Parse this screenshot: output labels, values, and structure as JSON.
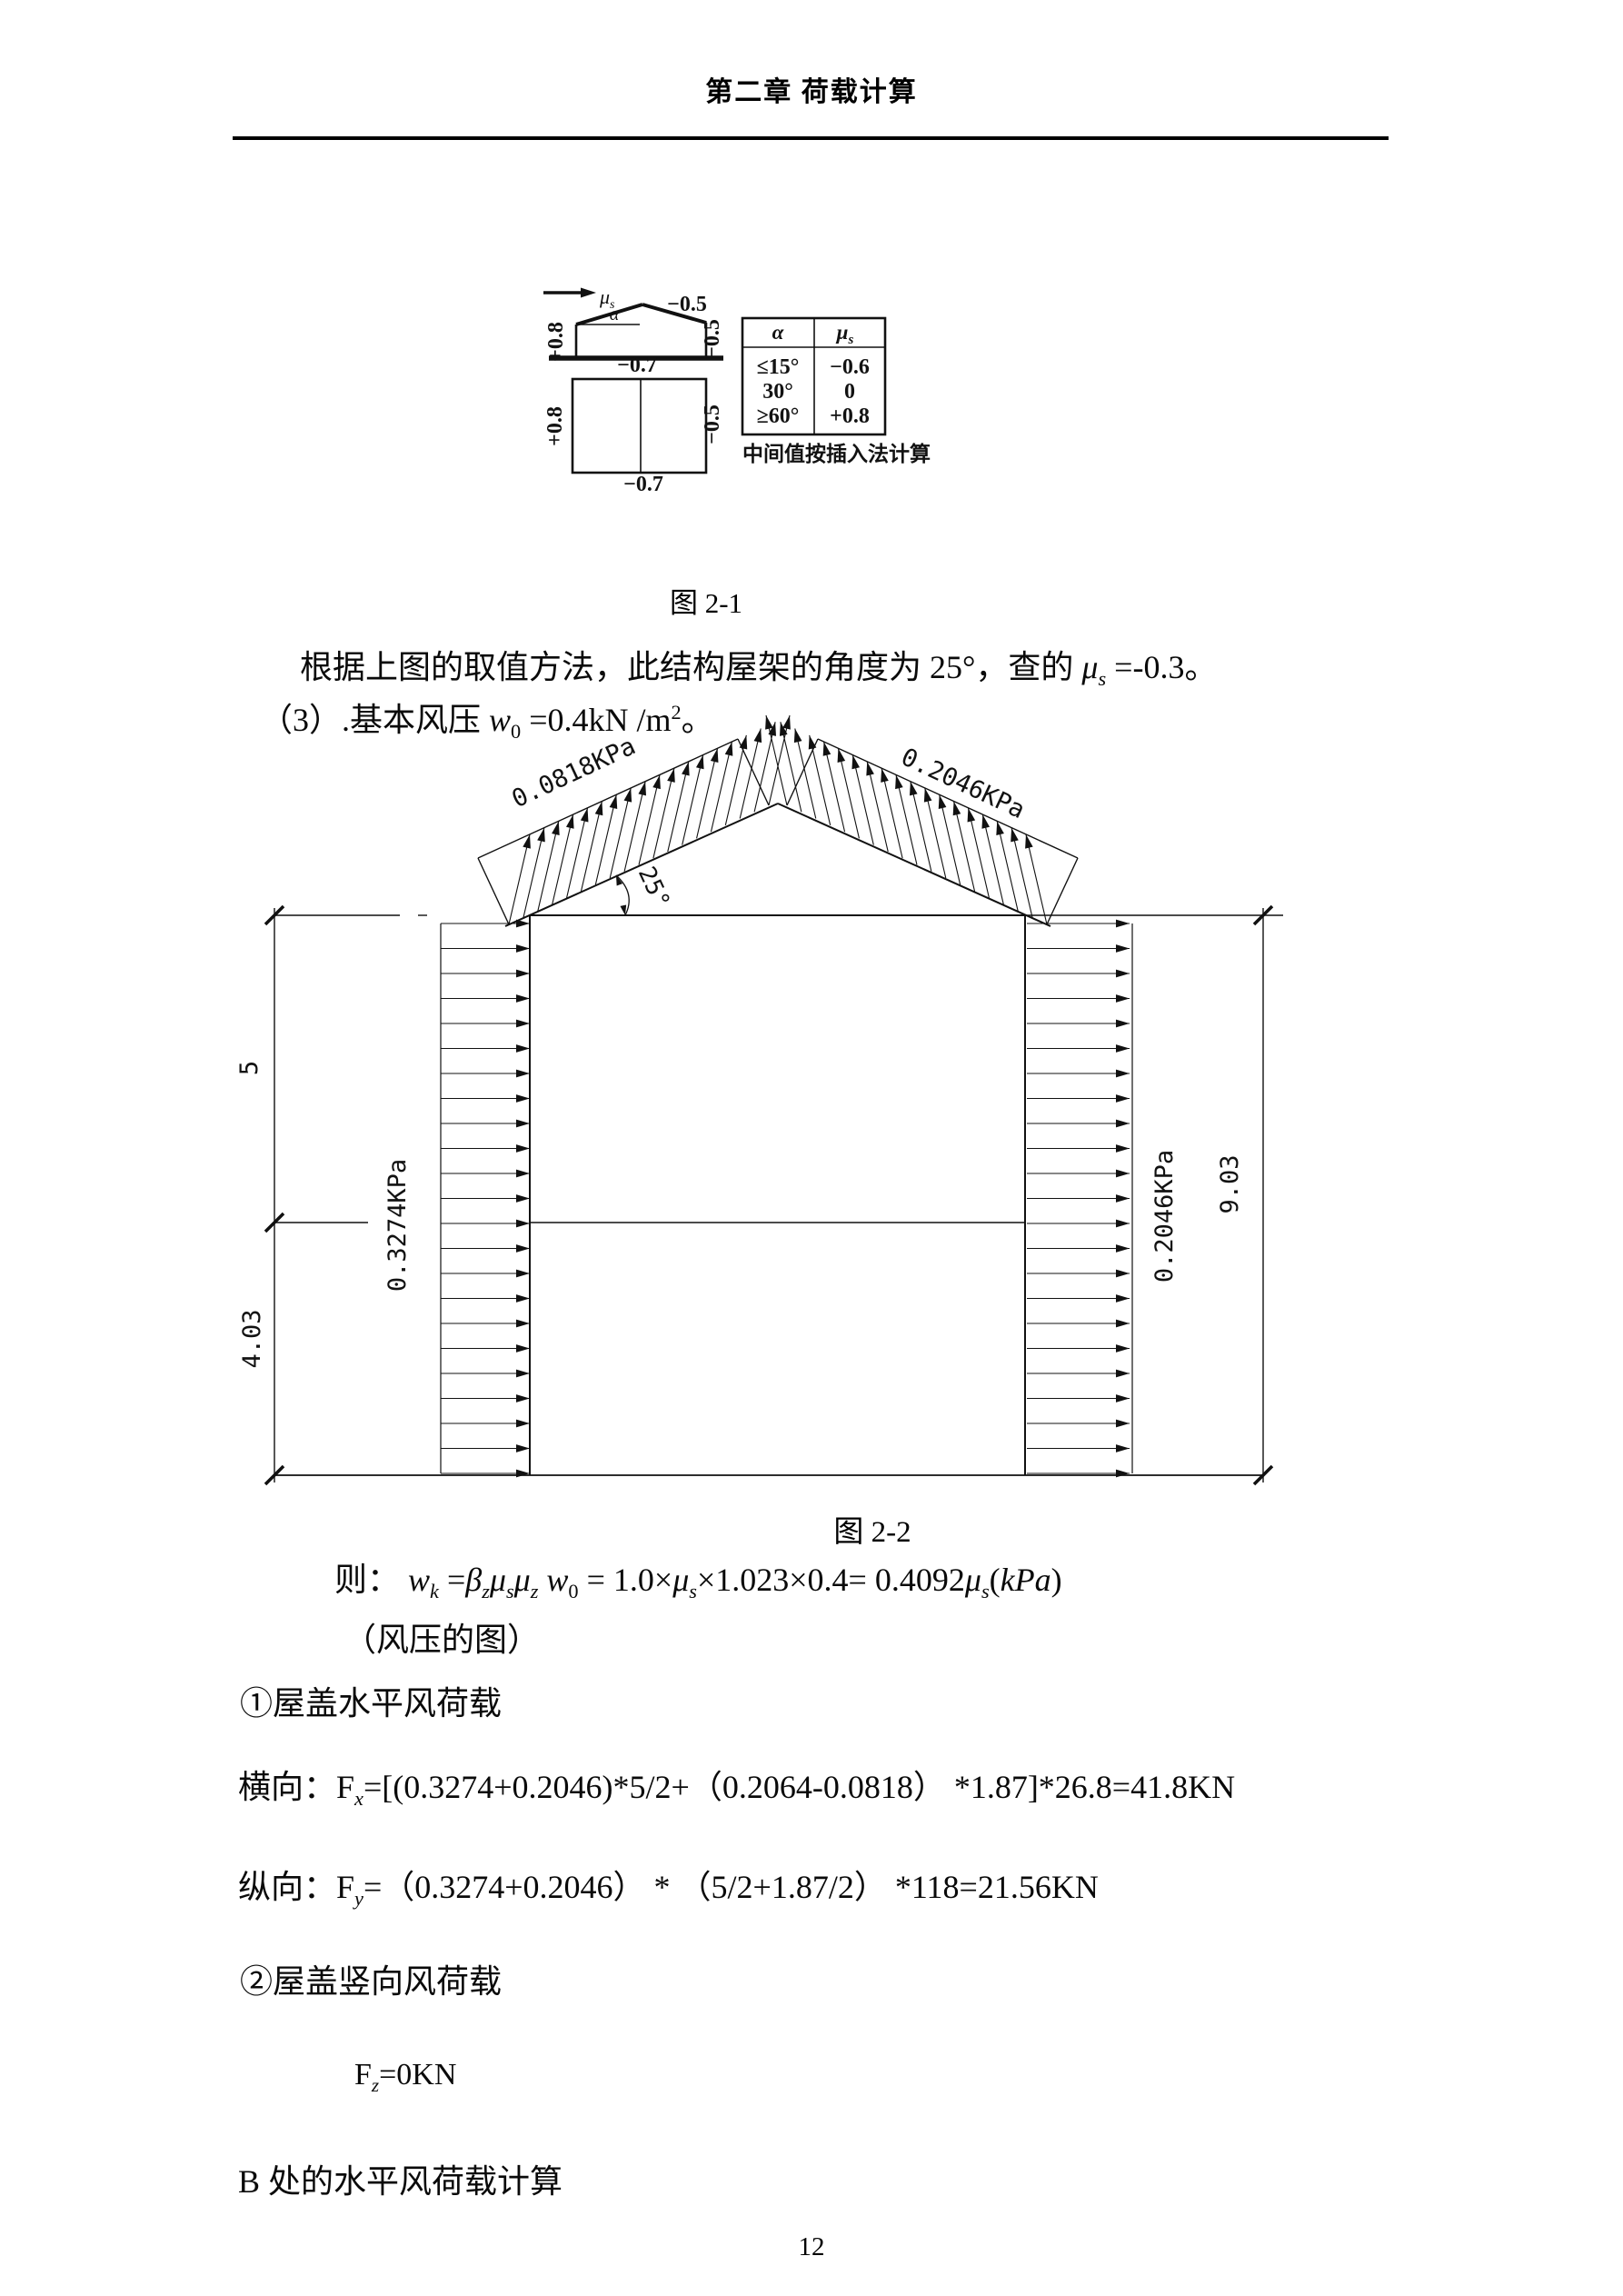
{
  "page": {
    "header_title": "第二章  荷载计算",
    "page_number": "12"
  },
  "figure1": {
    "caption": "图  2-1",
    "labels": {
      "mu": "μ",
      "mu_sub": "s",
      "alpha": "α",
      "roof_right": "−0.5",
      "wall_left": "+0.8",
      "wall_right": "−0.5",
      "plan_top": "−0.7",
      "plan_bottom": "−0.7",
      "plan_left": "+0.8",
      "plan_right": "−0.5"
    },
    "table": {
      "header_alpha": "α",
      "header_mu": "μ",
      "header_mu_sub": "s",
      "rows": [
        [
          "≤15°",
          "−0.6"
        ],
        [
          "30°",
          "0"
        ],
        [
          "≥60°",
          "+0.8"
        ]
      ]
    },
    "note": "中间值按插入法计算"
  },
  "figure2": {
    "caption": "图 2-2",
    "roof_left_pressure": "0.0818KPa",
    "roof_right_pressure": "0.2046KPa",
    "roof_angle": "25°",
    "left_wall_pressure": "0.3274KPa",
    "right_wall_pressure": "0.2046KPa",
    "dim_upper": "5",
    "dim_lower": "4.03",
    "dim_total": "9.03"
  },
  "text": {
    "p_mu": [
      {
        "t": "根据上图的取值方法，此结构屋架的角度为 25°，查的 "
      },
      {
        "t": "μ",
        "s": "it"
      },
      {
        "t": "s",
        "s": "subit"
      },
      {
        "t": " =-0.3。"
      }
    ],
    "p_w0": [
      {
        "t": "（3）.基本风压  "
      },
      {
        "t": "w",
        "s": "it"
      },
      {
        "t": "0",
        "s": "sub"
      },
      {
        "t": " =0.4kN /m"
      },
      {
        "t": "2",
        "s": "sup"
      },
      {
        "t": "。"
      }
    ],
    "f_wk": [
      {
        "t": "则：  "
      },
      {
        "t": "w",
        "s": "it"
      },
      {
        "t": "k",
        "s": "subit"
      },
      {
        "t": " ="
      },
      {
        "t": "β",
        "s": "it"
      },
      {
        "t": "z",
        "s": "subit"
      },
      {
        "t": "μ",
        "s": "it"
      },
      {
        "t": "s",
        "s": "subit"
      },
      {
        "t": "μ",
        "s": "it"
      },
      {
        "t": "z",
        "s": "subit"
      },
      {
        "t": " "
      },
      {
        "t": "w",
        "s": "it"
      },
      {
        "t": "0",
        "s": "sub"
      },
      {
        "t": " = 1.0×"
      },
      {
        "t": "μ",
        "s": "it"
      },
      {
        "t": "s",
        "s": "subit"
      },
      {
        "t": "×1.023×0.4= 0.4092"
      },
      {
        "t": "μ",
        "s": "it"
      },
      {
        "t": "s",
        "s": "subit"
      },
      {
        "t": "("
      },
      {
        "t": "kPa",
        "s": "it"
      },
      {
        "t": ")"
      }
    ],
    "p_fengya": "（风压的图）",
    "item1": "①屋盖水平风荷载",
    "f_fx": [
      {
        "t": "横向："
      },
      {
        "t": "F"
      },
      {
        "t": "x",
        "s": "subit"
      },
      {
        "t": "=[(0.3274+0.2046)*5/2+（0.2064-0.0818） *1.87]*26.8=41.8KN"
      }
    ],
    "f_fy": [
      {
        "t": "纵向："
      },
      {
        "t": "F"
      },
      {
        "t": "y",
        "s": "subit"
      },
      {
        "t": "=（0.3274+0.2046） * （5/2+1.87/2） *118=21.56KN"
      }
    ],
    "item2": "②屋盖竖向风荷载",
    "f_fz": [
      {
        "t": "F"
      },
      {
        "t": "z",
        "s": "subit"
      },
      {
        "t": "=0KN"
      }
    ],
    "sectionB": "B 处的水平风荷载计算"
  }
}
